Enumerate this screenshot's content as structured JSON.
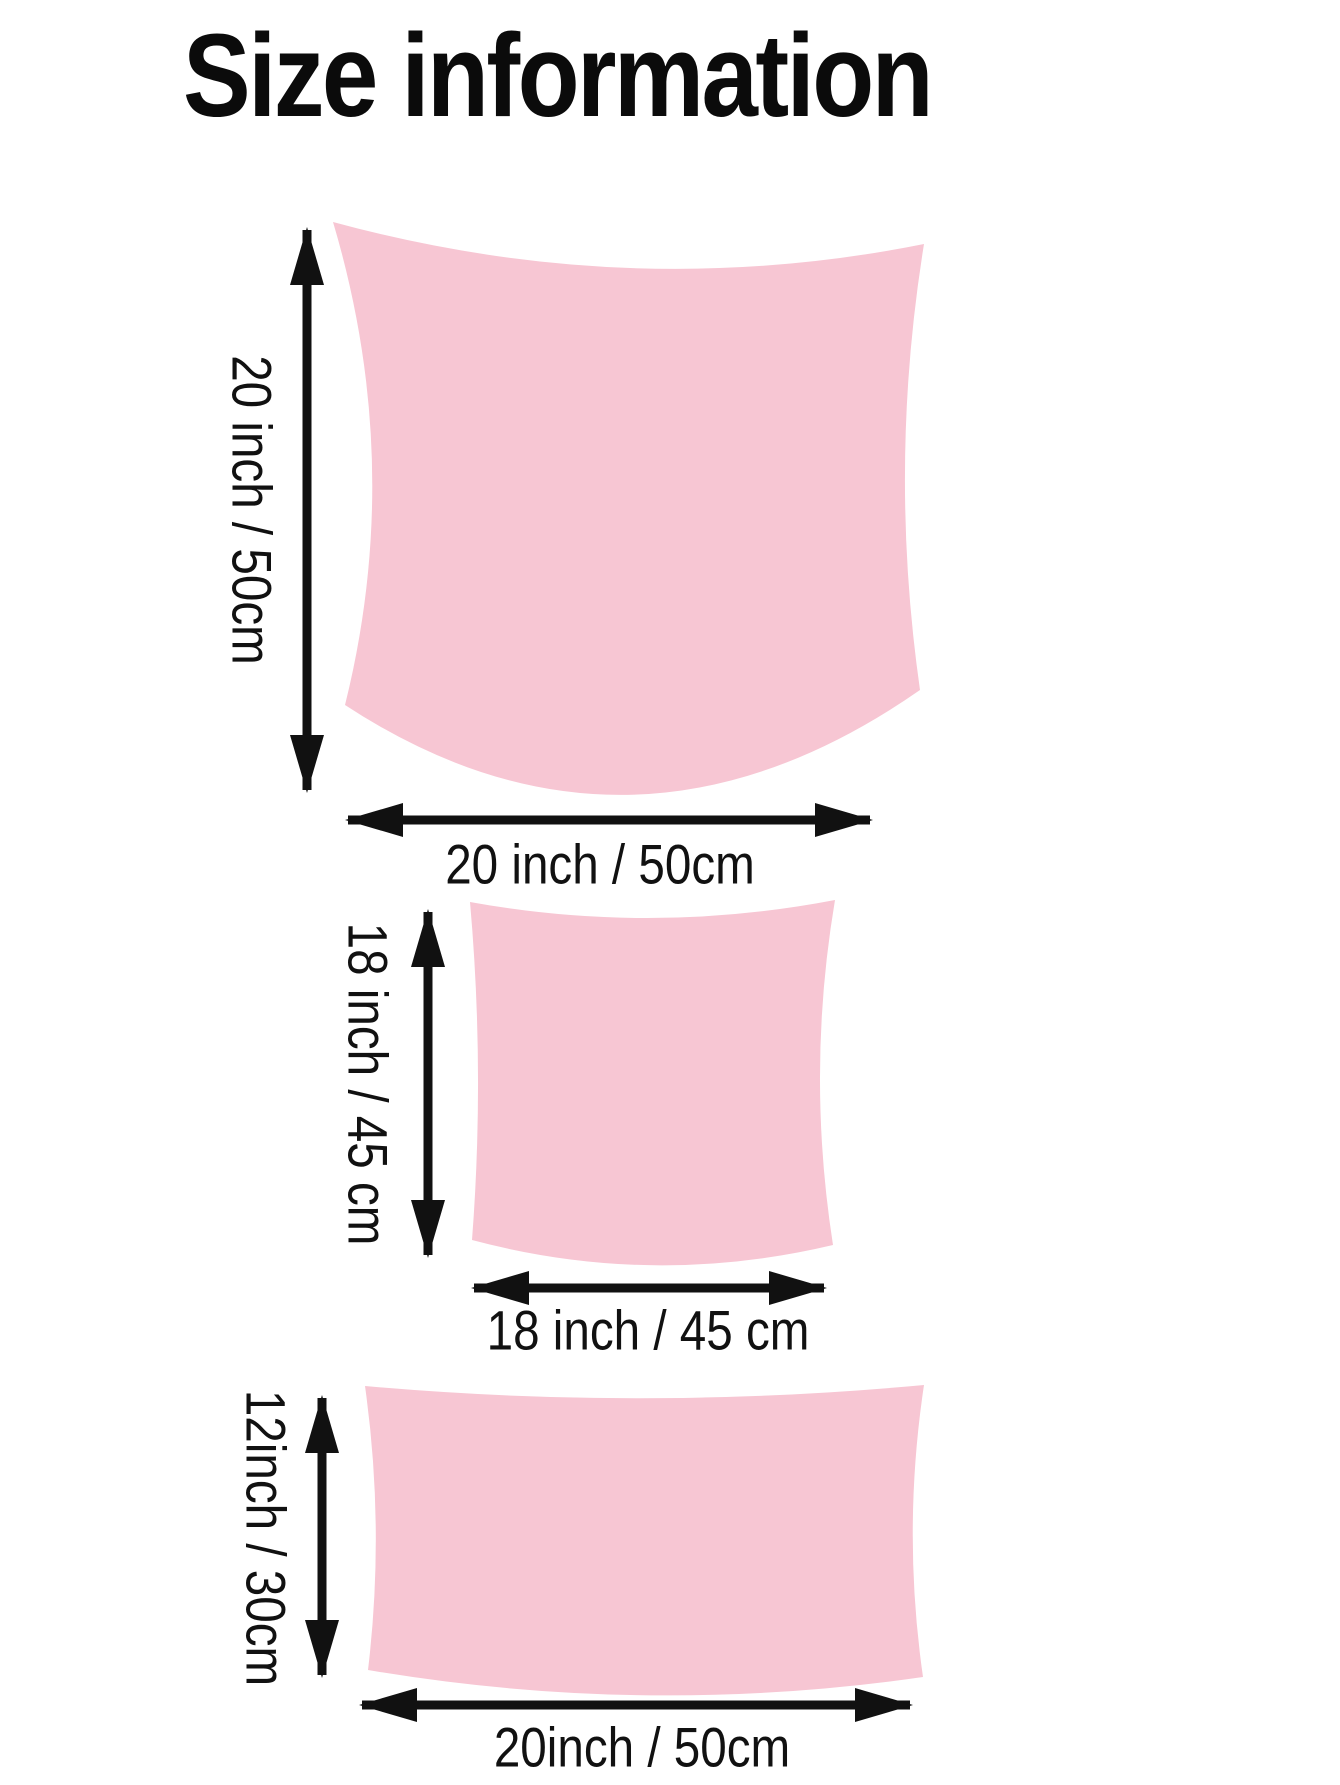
{
  "title": "Size information",
  "colors": {
    "pillow_fill": "#F7C6D3",
    "ink": "#111111"
  },
  "pillows": [
    {
      "size_name": "large square",
      "height_label": "20 inch / 50cm",
      "width_label": "20 inch / 50cm"
    },
    {
      "size_name": "medium square",
      "height_label": "18 inch / 45 cm",
      "width_label": "18 inch / 45 cm"
    },
    {
      "size_name": "lumbar rectangle",
      "height_label": "12inch / 30cm",
      "width_label": "20inch / 50cm"
    }
  ]
}
